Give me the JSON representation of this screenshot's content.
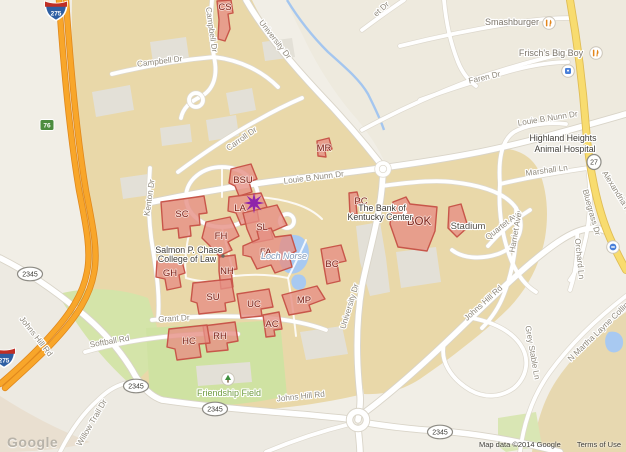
{
  "attribution": {
    "google": "Google",
    "map_data": "Map data ©2014 Google",
    "terms": "Terms of Use"
  },
  "shields": {
    "i275": "275",
    "marker76": "76",
    "r2345": "2345",
    "us27": "27"
  },
  "buildings": {
    "cs": "CS",
    "sc": "SC",
    "bsu": "BSU",
    "la": "LA",
    "fh": "FH",
    "sl": "SL",
    "fa": "FA.",
    "nh": "NH",
    "gh": "GH",
    "bc": "BC",
    "su": "SU",
    "uc": "UC",
    "mp": "MP",
    "ac": "AC",
    "rh": "RH",
    "hc": "HC",
    "mr": "MR",
    "pc": "PC",
    "bok": "BOK"
  },
  "places": {
    "stadium": "Stadium",
    "smashburger": "Smashburger",
    "frischs": "Frisch's Big Boy",
    "animal_hospital_line1": "Highland Heights",
    "animal_hospital_line2": "Animal Hospital",
    "bank_line1": "The Bank of",
    "bank_line2": "Kentucky Center",
    "chase_line1": "Salmon P. Chase",
    "chase_line2": "College of Law",
    "friendship_field": "Friendship Field",
    "loch_norse": "Loch Norse"
  },
  "roads": {
    "university_dr": "University Dr",
    "campbell_dr": "Campbell Dr",
    "carroll_dr": "Carroll Dr",
    "kenton_dr": "Kenton Dr",
    "louie_b_nunn_dr": "Louie B Nunn Dr",
    "et_dr": "et Dr",
    "faren_dr": "Faren Dr",
    "marshall_ln": "Marshall Ln",
    "alexandria_pike": "Alexandria Pike",
    "bluegrass_dr": "Bluegrass Dr",
    "orchard_ln": "Orchard Ln",
    "quartet_ave": "Quartet Ave",
    "harriet_ave": "Harriet Ave",
    "johns_hill_rd": "Johns Hill Rd",
    "softball_rd": "Softball Rd",
    "grant_dr": "Grant Dr",
    "willow_trail_dr": "Willow Trail Dr",
    "grey_stable_ln": "Grey Stable Ln",
    "martha_layne_collins": "N Martha Layne Collins Blvd"
  },
  "icons": {
    "restaurant": "restaurant-icon",
    "tree": "tree-icon",
    "poi_blue": "blue-poi-icon",
    "lodging": "lodging-icon",
    "star": "purple-star-marker"
  },
  "colors": {
    "campus_fill": "#e9d8a9",
    "building_fill": "#e69084",
    "building_stroke": "#c8564a",
    "building_label": "#7d241b",
    "highway_orange": "#f8a62a",
    "route_yellow": "#f8dc6f",
    "water_blue": "#a8c9f1",
    "park_green": "#d4e4a9",
    "road_label_gray": "#8f897c",
    "star_purple": "#8e24aa",
    "poi_orange": "#e2861b",
    "poi_blue": "#4a80d9"
  }
}
